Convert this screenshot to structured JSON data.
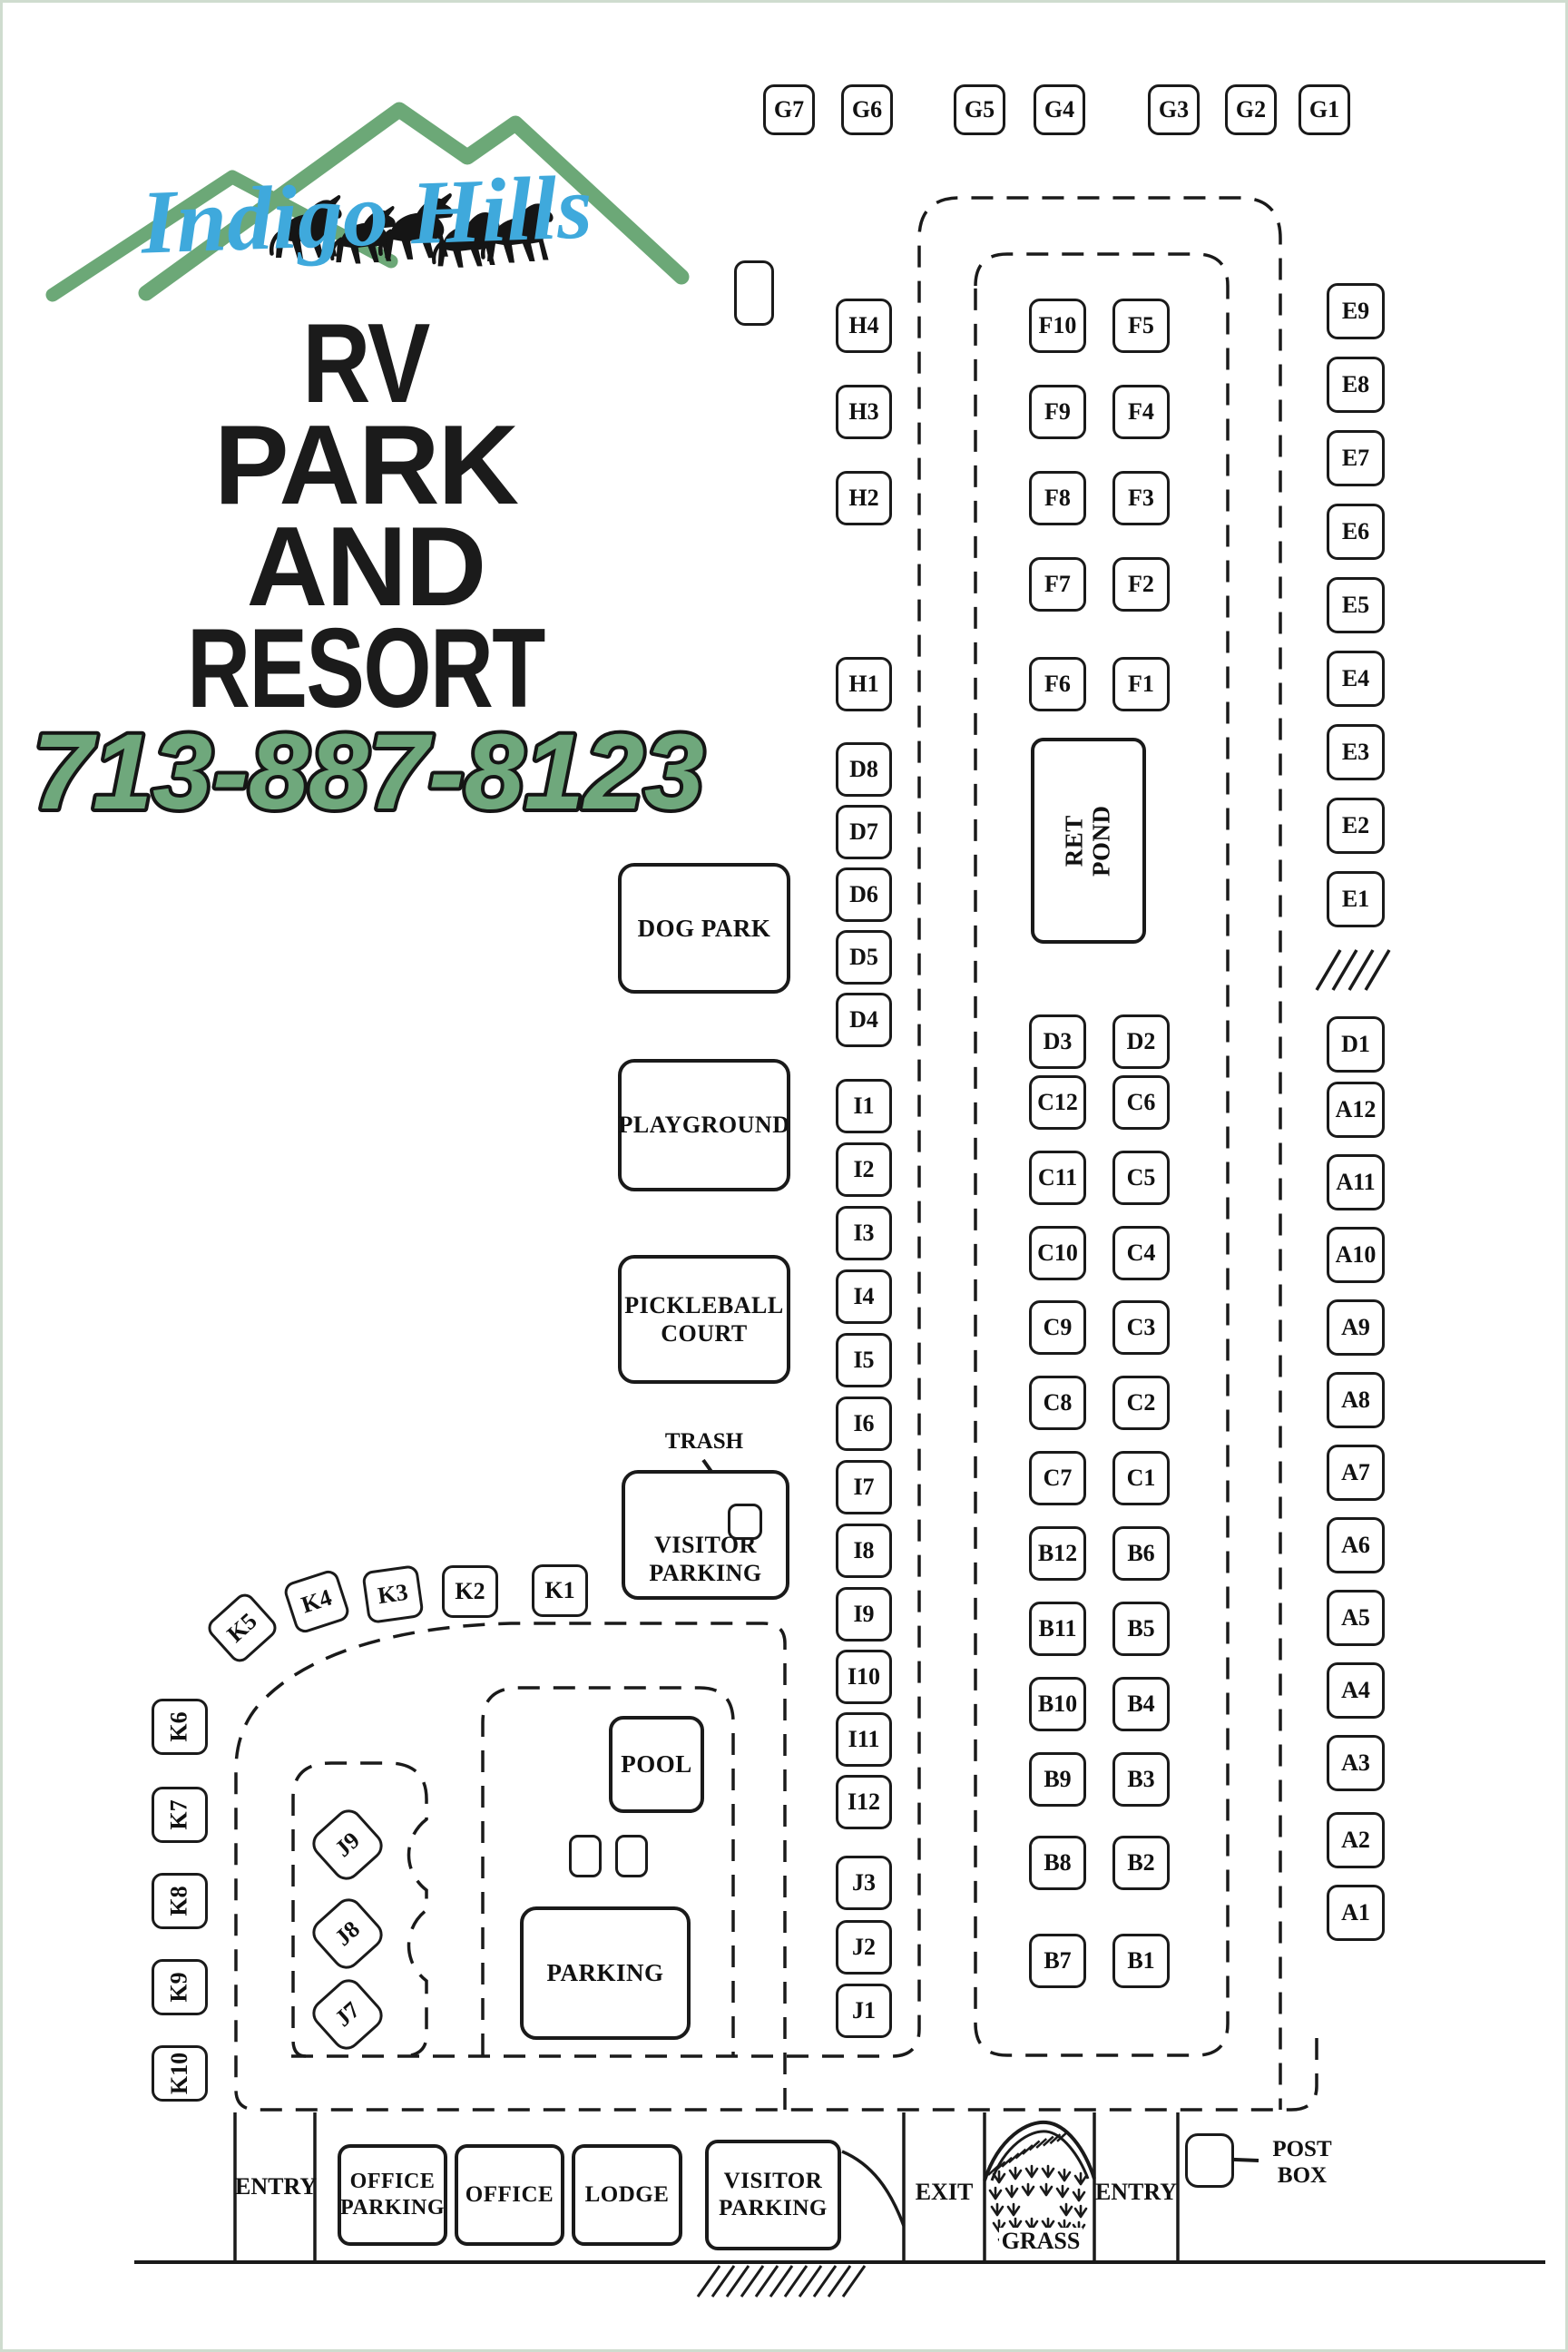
{
  "brand": {
    "name": "Indigo Hills",
    "title_lines": {
      "l1": "RV",
      "l2": "PARK",
      "l3": "AND",
      "l4": "RESORT"
    },
    "phone": "713-887-8123"
  },
  "colors": {
    "mountain_green": "#6CA877",
    "script_blue": "#3FA9DC",
    "phone_green": "#6FA87C",
    "ink": "#1a1a1a"
  },
  "sites": {
    "g_row": [
      "G7",
      "G6",
      "G5",
      "G4",
      "G3",
      "G2",
      "G1"
    ],
    "h_col": [
      "H4",
      "H3",
      "H2",
      "H1"
    ],
    "d_left": [
      "D8",
      "D7",
      "D6",
      "D5",
      "D4"
    ],
    "i_col": [
      "I1",
      "I2",
      "I3",
      "I4",
      "I5",
      "I6",
      "I7",
      "I8",
      "I9",
      "I10",
      "I11",
      "I12"
    ],
    "j_col": [
      "J3",
      "J2",
      "J1"
    ],
    "f_pairs": [
      [
        "F10",
        "F5"
      ],
      [
        "F9",
        "F4"
      ],
      [
        "F8",
        "F3"
      ],
      [
        "F7",
        "F2"
      ],
      [
        "F6",
        "F1"
      ]
    ],
    "d_pair": [
      "D3",
      "D2"
    ],
    "c_pairs": [
      [
        "C12",
        "C6"
      ],
      [
        "C11",
        "C5"
      ],
      [
        "C10",
        "C4"
      ],
      [
        "C9",
        "C3"
      ],
      [
        "C8",
        "C2"
      ],
      [
        "C7",
        "C1"
      ]
    ],
    "b_pairs": [
      [
        "B12",
        "B6"
      ],
      [
        "B11",
        "B5"
      ],
      [
        "B10",
        "B4"
      ],
      [
        "B9",
        "B3"
      ],
      [
        "B8",
        "B2"
      ],
      [
        "B7",
        "B1"
      ]
    ],
    "e_col": [
      "E9",
      "E8",
      "E7",
      "E6",
      "E5",
      "E4",
      "E3",
      "E2",
      "E1"
    ],
    "d_right": "D1",
    "a_col": [
      "A12",
      "A11",
      "A10",
      "A9",
      "A8",
      "A7",
      "A6",
      "A5",
      "A4",
      "A3",
      "A2",
      "A1"
    ],
    "k_row": [
      "K5",
      "K4",
      "K3",
      "K2",
      "K1"
    ],
    "k_col": [
      "K6",
      "K7",
      "K8",
      "K9",
      "K10"
    ],
    "j_cluster": [
      "J9",
      "J8",
      "J7"
    ]
  },
  "labels": {
    "ret_pond": "RET\nPOND",
    "dog_park": "DOG PARK",
    "playground": "PLAYGROUND",
    "pickleball": "PICKLEBALL\nCOURT",
    "trash": "TRASH",
    "visitor_parking": "VISITOR\nPARKING",
    "pool": "POOL",
    "parking": "PARKING"
  },
  "bottom": {
    "entry_left": "ENTRY",
    "office_parking": "OFFICE\nPARKING",
    "office": "OFFICE",
    "lodge": "LODGE",
    "visitor_parking": "VISITOR\nPARKING",
    "exit": "EXIT",
    "grass": "GRASS",
    "entry_right": "ENTRY",
    "post_box": "POST\nBOX"
  }
}
